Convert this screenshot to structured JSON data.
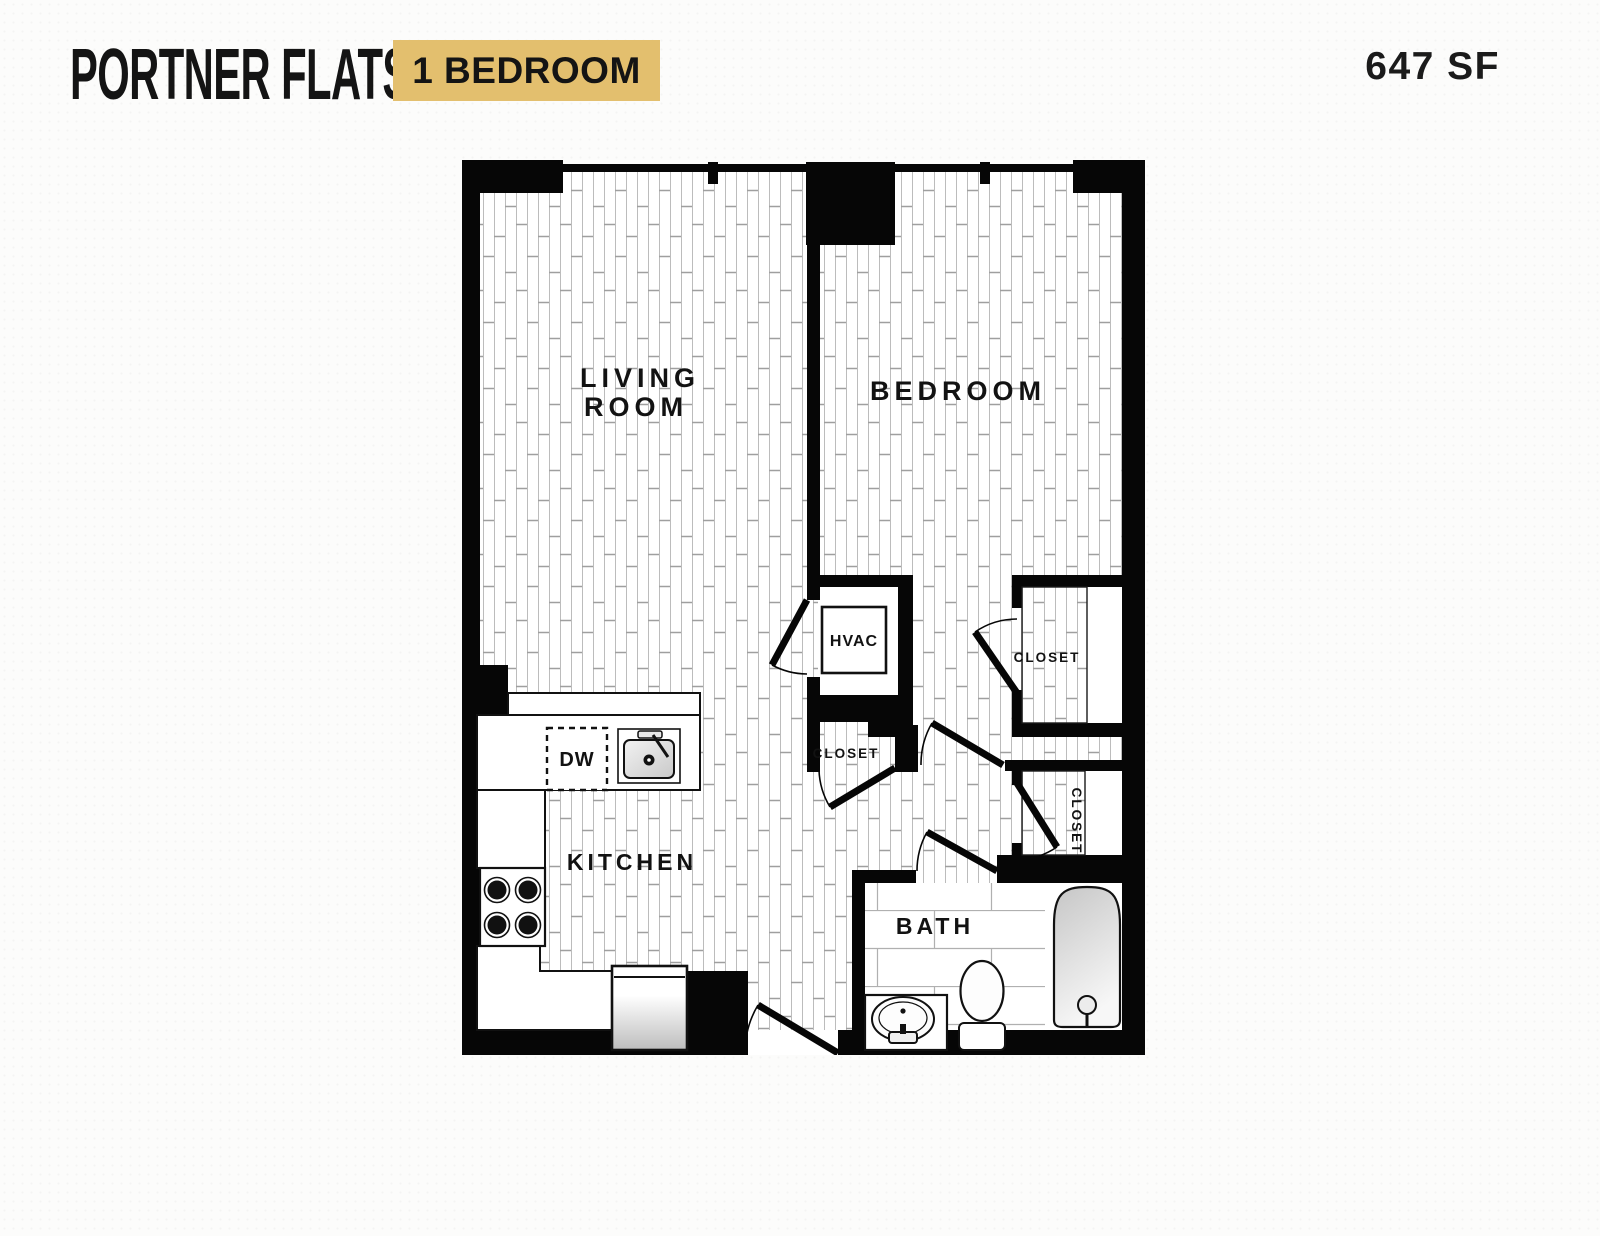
{
  "header": {
    "title": "PORTNER FLATS",
    "badge": "1 BEDROOM",
    "area": "647 SF"
  },
  "colors": {
    "badge_bg": "#e3bf6e",
    "wall": "#060606",
    "page_bg": "#fcfcfb",
    "plank_line": "#b5b5b5",
    "plank_joint": "#a0a0a0",
    "tile_line": "#b0b0b0"
  },
  "rooms": {
    "living_room_line1": "LIVING",
    "living_room_line2": "ROOM",
    "bedroom": "BEDROOM",
    "kitchen": "KITCHEN",
    "bath": "BATH",
    "hvac": "HVAC",
    "closet_hall": "CLOSET",
    "closet_bedroom": "CLOSET",
    "closet_side": "CLOSET",
    "dishwasher": "DW"
  }
}
